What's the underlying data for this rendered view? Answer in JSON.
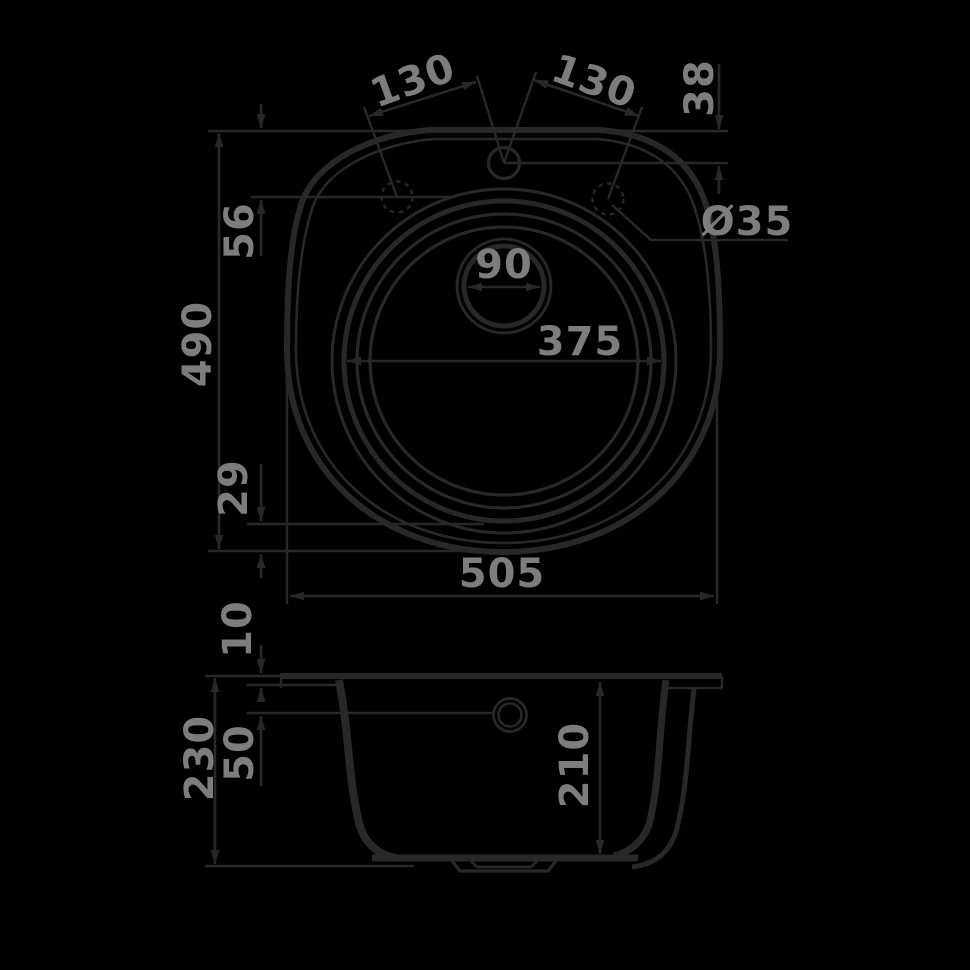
{
  "meta": {
    "description": "Technical dimension drawing of a round kitchen sink: top view and front section view",
    "background_color": "#000000",
    "line_color": "#282828",
    "label_color": "#7d7d7d"
  },
  "views": {
    "plan": {
      "name": "top-view",
      "labels": {
        "hole_pitch_left": "130",
        "hole_pitch_right": "130",
        "top_hole_offset": "38",
        "side_hole_offset": "56",
        "overall_depth": "490",
        "bowl_to_edge_offset": "29",
        "overall_width": "505",
        "bowl_diameter": "375",
        "drain_dimension": "90",
        "faucet_hole_diameter": "Ø35"
      }
    },
    "section": {
      "name": "front-section-view",
      "labels": {
        "rim_thickness": "10",
        "drain_center_offset": "50",
        "overall_height": "230",
        "bowl_depth": "210"
      }
    }
  }
}
